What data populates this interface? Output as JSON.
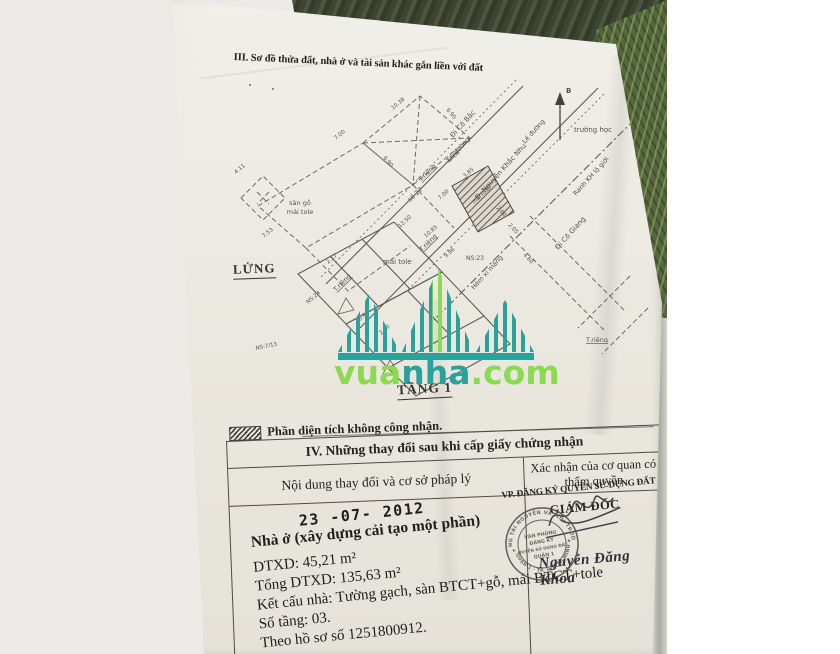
{
  "section3": {
    "title": "III. Sơ đồ thửa đất, nhà ở và tài sản khác gắn liền với đất"
  },
  "diagram": {
    "lung": "LỬNG",
    "tang1": "TẦNG 1",
    "north_label": "B",
    "truong_hoc": "trường học",
    "le_duong": "Lề đường",
    "ranh_lo_gioi": "Ranh KH lộ giới",
    "di_co_bac": "Đi Cô Bắc",
    "di_co_giang": "Đi Cô Giang",
    "duong_nkn": "Đ. Nguyễn Khắc Nhu",
    "hem_xi_mang": "Hẻm xi măng",
    "san_go": "sàn gỗ",
    "mai_tole": "mái tole",
    "t_rieng": "T.riêng",
    "so_27": "số 27",
    "ns23": "NS:23",
    "ns24": "NS:24",
    "ns713": "NS:7/13",
    "dims": [
      "10.38",
      "6.90",
      "7.00",
      "13.06",
      "4.11",
      "7.53",
      "6.90",
      "2.17",
      "12.50",
      "10.85",
      "9.96",
      "3.85",
      "2.60",
      "2.05",
      "3.46",
      "2.10",
      "7.00",
      "4.60"
    ]
  },
  "watermark": {
    "part1": "vua",
    "part2": "nha",
    "part3": ".com"
  },
  "legend": {
    "text": "Phần diện tích không công nhận."
  },
  "table4": {
    "title": "IV. Những thay đổi sau khi cấp giấy chứng nhận",
    "col1": "Nội dung thay đổi và cơ sở pháp lý",
    "col2": "Xác nhận của cơ quan có thẩm quyền"
  },
  "changes": {
    "date_stamp": "23 -07- 2012",
    "line1": "Nhà ở (xây dựng cải tạo một phần)",
    "line2": "DTXD: 45,21 m²",
    "line3": "Tổng DTXD: 135,63 m²",
    "line4": "Kết cấu nhà: Tường gạch, sàn BTCT+gỗ, mái BTCT+tole",
    "line5": "Số tầng: 03.",
    "line6": "Theo hồ sơ số 1251800912."
  },
  "authority": {
    "office": "VP. ĐĂNG KÝ QUYỀN SỬ DỤNG ĐẤT QUẬN 1",
    "role": "GIÁM ĐỐC",
    "signer": "Nguyễn Đăng Khoa",
    "seal_ring_top": "PHÒNG TÀI NGUYÊN VÀ MÔI TRƯỜNG",
    "seal_ring_bottom": "QUẬN 1 · TP. HỒ CHÍ MINH",
    "seal_line1": "VĂN PHÒNG",
    "seal_line2": "ĐĂNG KÝ",
    "seal_line3": "QUYỀN SỬ DỤNG ĐẤT",
    "seal_line4": "QUẬN 1",
    "seal_star": "★"
  },
  "colors": {
    "teal": "#2ba19c",
    "green": "#8cd952"
  }
}
